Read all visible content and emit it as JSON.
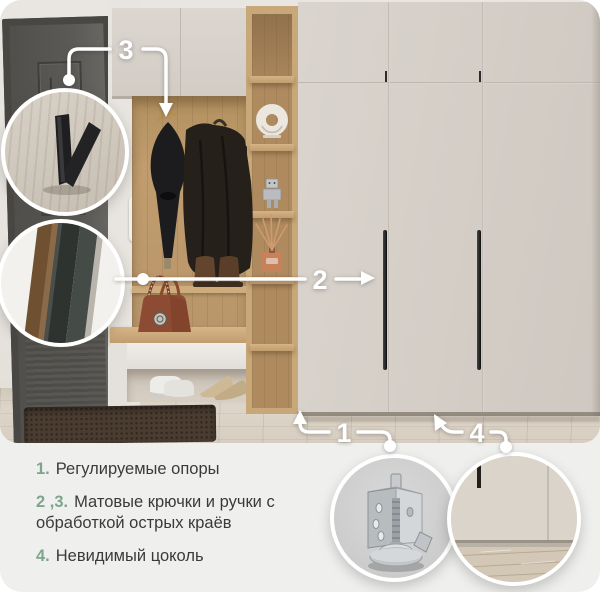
{
  "callouts": {
    "one": "1",
    "two": "2",
    "three": "3",
    "four": "4"
  },
  "features": [
    {
      "num": "1.",
      "text": "Регулируемые опоры"
    },
    {
      "num": "2 ,3.",
      "text": "Матовые крючки и ручки с обработкой острых краёв"
    },
    {
      "num": "4.",
      "text": "Невидимый цоколь"
    }
  ],
  "colors": {
    "accent_green": "#7ea58c",
    "card_background": "#eff0ee",
    "callout_white": "#ffffff",
    "wardrobe_front": "#d5cfc8",
    "oak_wood": "#c2a072",
    "entry_door": "#56544f"
  }
}
